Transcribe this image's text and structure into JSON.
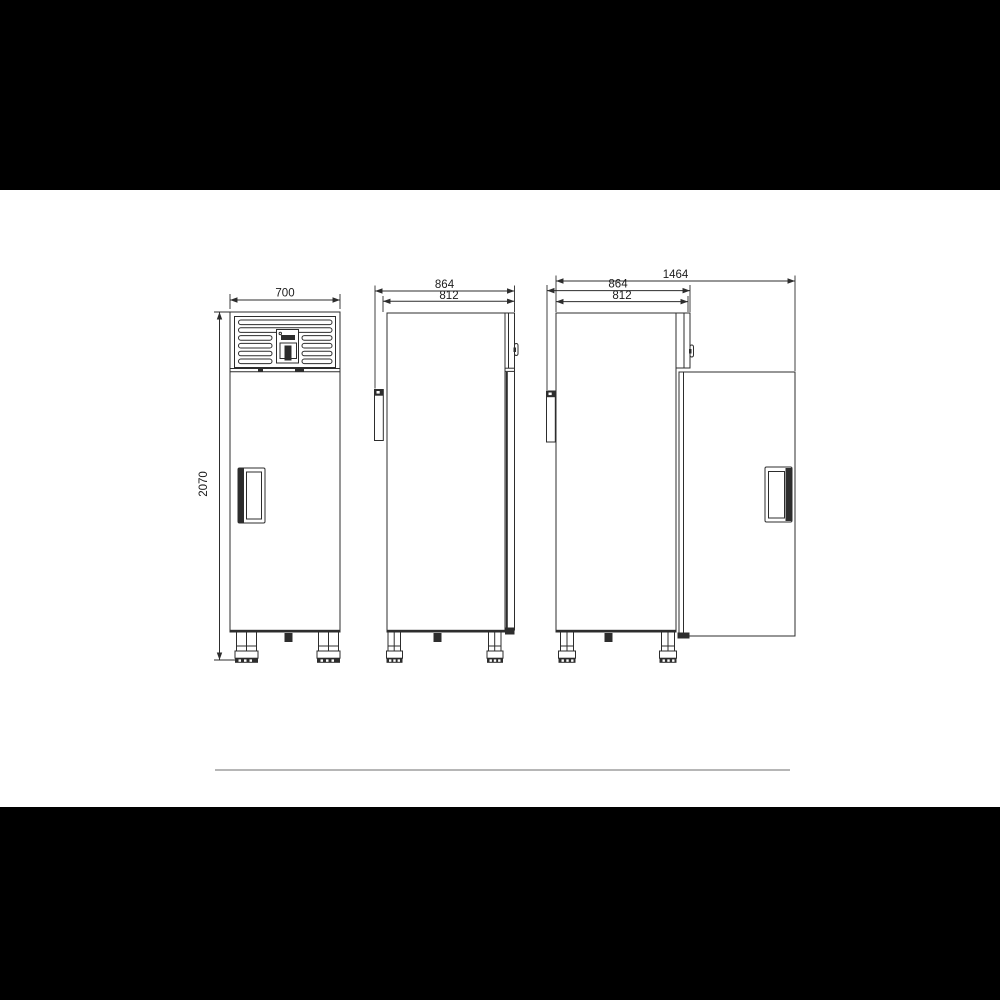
{
  "colors": {
    "background": "#000000",
    "paper": "#ffffff",
    "line": "#2d2d2d",
    "divider": "#b6b6b6"
  },
  "dimensions": {
    "front": {
      "width": "700",
      "height": "2070"
    },
    "side": {
      "depth_total": "864",
      "depth_body": "812"
    },
    "side_open": {
      "width_total": "1464",
      "depth_total": "864",
      "depth_body": "812"
    }
  }
}
